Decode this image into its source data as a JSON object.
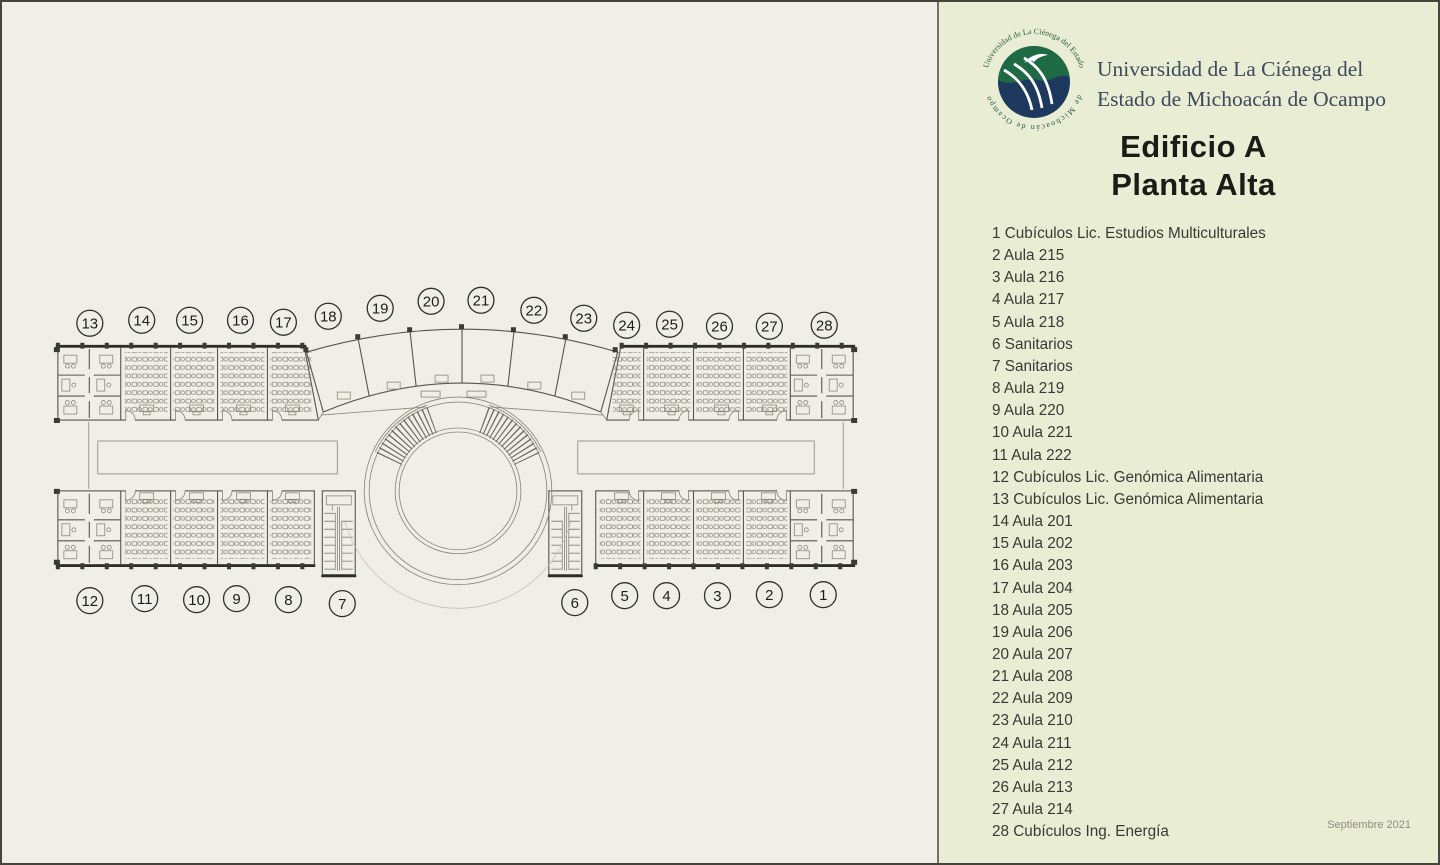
{
  "panel": {
    "university_line1": "Universidad de La Ciénega del",
    "university_line2": "Estado de Michoacán de Ocampo",
    "title_line1": "Edificio A",
    "title_line2": "Planta Alta",
    "date_note": "Septiembre 2021",
    "logo_ring_text_top": "Universidad de La Ciénega del Estado",
    "logo_ring_text_bottom": "de Michoacán de Ocampo"
  },
  "colors": {
    "plan_bg": "#f0efe7",
    "panel_bg": "#e9edd3",
    "logo_green": "#1e6a45",
    "logo_navy": "#1d3a5e",
    "uni_text": "#3e4a5c",
    "title_color": "#1b1b18",
    "legend_color": "#3a3a35",
    "date_color": "#8e8e80"
  },
  "legend": {
    "items": [
      {
        "n": 1,
        "label": "Cubículos Lic. Estudios Multiculturales"
      },
      {
        "n": 2,
        "label": "Aula 215"
      },
      {
        "n": 3,
        "label": "Aula 216"
      },
      {
        "n": 4,
        "label": "Aula 217"
      },
      {
        "n": 5,
        "label": "Aula 218"
      },
      {
        "n": 6,
        "label": "Sanitarios"
      },
      {
        "n": 7,
        "label": "Sanitarios"
      },
      {
        "n": 8,
        "label": "Aula 219"
      },
      {
        "n": 9,
        "label": "Aula 220"
      },
      {
        "n": 10,
        "label": "Aula 221"
      },
      {
        "n": 11,
        "label": "Aula 222"
      },
      {
        "n": 12,
        "label": "Cubículos Lic. Genómica Alimentaria"
      },
      {
        "n": 13,
        "label": "Cubículos Lic. Genómica Alimentaria"
      },
      {
        "n": 14,
        "label": "Aula 201"
      },
      {
        "n": 15,
        "label": "Aula 202"
      },
      {
        "n": 16,
        "label": "Aula 203"
      },
      {
        "n": 17,
        "label": "Aula 204"
      },
      {
        "n": 18,
        "label": "Aula 205"
      },
      {
        "n": 19,
        "label": "Aula 206"
      },
      {
        "n": 20,
        "label": "Aula 207"
      },
      {
        "n": 21,
        "label": "Aula 208"
      },
      {
        "n": 22,
        "label": "Aula 209"
      },
      {
        "n": 23,
        "label": "Aula 210"
      },
      {
        "n": 24,
        "label": "Aula 211"
      },
      {
        "n": 25,
        "label": "Aula 212"
      },
      {
        "n": 26,
        "label": "Aula 213"
      },
      {
        "n": 27,
        "label": "Aula 214"
      },
      {
        "n": 28,
        "label": "Cubículos Ing. Energía"
      }
    ]
  },
  "plan": {
    "bubbles": [
      {
        "n": 1,
        "x": 823,
        "y": 593
      },
      {
        "n": 2,
        "x": 769,
        "y": 593
      },
      {
        "n": 3,
        "x": 717,
        "y": 594
      },
      {
        "n": 4,
        "x": 666,
        "y": 594
      },
      {
        "n": 5,
        "x": 624,
        "y": 594
      },
      {
        "n": 6,
        "x": 574,
        "y": 601
      },
      {
        "n": 7,
        "x": 341,
        "y": 602
      },
      {
        "n": 8,
        "x": 287,
        "y": 598
      },
      {
        "n": 9,
        "x": 235,
        "y": 597
      },
      {
        "n": 10,
        "x": 195,
        "y": 598
      },
      {
        "n": 11,
        "x": 143,
        "y": 597
      },
      {
        "n": 12,
        "x": 88,
        "y": 599
      },
      {
        "n": 13,
        "x": 88,
        "y": 321
      },
      {
        "n": 14,
        "x": 140,
        "y": 318
      },
      {
        "n": 15,
        "x": 188,
        "y": 318
      },
      {
        "n": 16,
        "x": 239,
        "y": 318
      },
      {
        "n": 17,
        "x": 282,
        "y": 320
      },
      {
        "n": 18,
        "x": 327,
        "y": 314
      },
      {
        "n": 19,
        "x": 379,
        "y": 306
      },
      {
        "n": 20,
        "x": 430,
        "y": 299
      },
      {
        "n": 21,
        "x": 480,
        "y": 298
      },
      {
        "n": 22,
        "x": 533,
        "y": 308
      },
      {
        "n": 23,
        "x": 583,
        "y": 316
      },
      {
        "n": 24,
        "x": 626,
        "y": 323
      },
      {
        "n": 25,
        "x": 669,
        "y": 322
      },
      {
        "n": 26,
        "x": 719,
        "y": 324
      },
      {
        "n": 27,
        "x": 769,
        "y": 324
      },
      {
        "n": 28,
        "x": 824,
        "y": 323
      }
    ]
  }
}
